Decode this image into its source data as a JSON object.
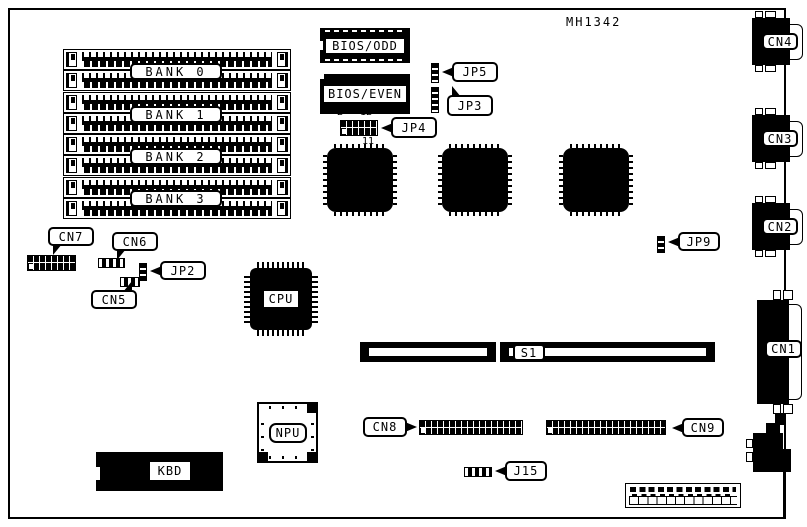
{
  "board": {
    "part_number": "MH1342",
    "colors": {
      "ink": "#000000",
      "paper": "#ffffff"
    }
  },
  "banks": [
    {
      "label": "BANK 0"
    },
    {
      "label": "BANK 1"
    },
    {
      "label": "BANK 2"
    },
    {
      "label": "BANK 3"
    }
  ],
  "chips": {
    "bios_odd": "BIOS/ODD",
    "bios_even": "BIOS/EVEN",
    "cpu": "CPU",
    "npu": "NPU",
    "kbd": "KBD"
  },
  "jumpers": {
    "jp2": "JP2",
    "jp3": "JP3",
    "jp4": "JP4",
    "jp5": "JP5",
    "jp9": "JP9",
    "j15": "J15"
  },
  "jp4_pins": {
    "top_first": "2",
    "top_last": "12",
    "bottom_last": "11"
  },
  "connectors": {
    "cn1": "CN1",
    "cn2": "CN2",
    "cn3": "CN3",
    "cn4": "CN4",
    "cn5": "CN5",
    "cn6": "CN6",
    "cn7": "CN7",
    "cn8": "CN8",
    "cn9": "CN9",
    "s1": "S1"
  }
}
